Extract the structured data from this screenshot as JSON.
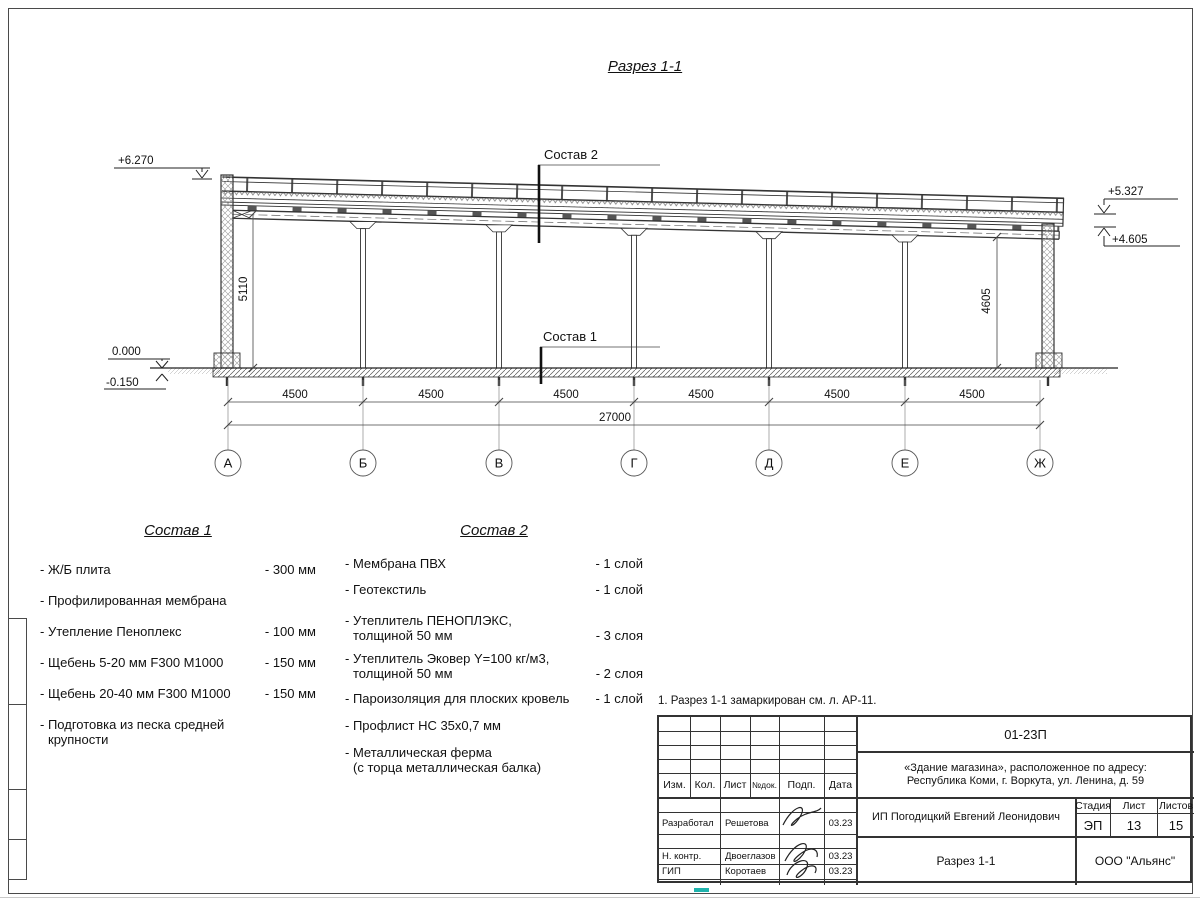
{
  "drawing": {
    "title": "Разрез 1-1",
    "callout_sostav2": "Состав 2",
    "callout_sostav1": "Состав 1",
    "elev_top_left": "+6.270",
    "elev_right_upper": "+5.327",
    "elev_right_lower": "+4.605",
    "elev_zero": "0.000",
    "elev_minus": "-0.150",
    "dim_left_height": "5110",
    "dim_right_height": "4605",
    "bay_dims": [
      "4500",
      "4500",
      "4500",
      "4500",
      "4500",
      "4500"
    ],
    "total_dim": "27000",
    "axes": [
      "А",
      "Б",
      "В",
      "Г",
      "Д",
      "Е",
      "Ж"
    ]
  },
  "sostav1": {
    "title": "Состав 1",
    "items": [
      {
        "name": "- Ж/Б плита",
        "value": "- 300 мм"
      },
      {
        "name": "- Профилированная мембрана",
        "value": ""
      },
      {
        "name": "- Утепление Пеноплекс",
        "value": "- 100 мм"
      },
      {
        "name": "-  Щебень 5-20 мм F300 М1000",
        "value": "- 150 мм"
      },
      {
        "name": "-  Щебень 20-40 мм F300 М1000",
        "value": "- 150 мм"
      },
      {
        "name": "- Подготовка из песка средней",
        "name2": "крупности",
        "value": ""
      }
    ]
  },
  "sostav2": {
    "title": "Состав 2",
    "items": [
      {
        "name": "- Мембрана ПВХ",
        "value": "- 1 слой"
      },
      {
        "name": "- Геотекстиль",
        "value": "- 1 слой"
      },
      {
        "name": "- Утеплитель ПЕНОПЛЭКС,",
        "name2": "толщиной 50 мм",
        "value": "- 3 слоя"
      },
      {
        "name": "- Утеплитель Эковер Y=100 кг/м3,",
        "name2": "толщиной 50 мм",
        "value": "- 2 слоя"
      },
      {
        "name": "- Пароизоляция для плоских кровель",
        "value": "- 1 слой"
      },
      {
        "name": "- Профлист НС 35х0,7 мм",
        "value": ""
      },
      {
        "name": "- Металлическая ферма",
        "name2": "(с торца металлическая балка)",
        "value": ""
      }
    ]
  },
  "note": "1. Разрез 1-1 замаркирован см. л. АР-11.",
  "titleblock": {
    "doc_number": "01-23П",
    "object_line1": "«Здание магазина», расположенное по адресу:",
    "object_line2": "Республика Коми, г. Воркута, ул. Ленина, д. 59",
    "client": "ИП Погодицкий Евгений Леонидович",
    "sheet_title": "Разрез 1-1",
    "company": "ООО \"Альянс\"",
    "stage_label": "Стадия",
    "stage_value": "ЭП",
    "sheet_label": "Лист",
    "sheet_value": "13",
    "sheets_label": "Листов",
    "sheets_value": "15",
    "cols": [
      "Изм.",
      "Кол.",
      "Лист",
      "№док.",
      "Подп.",
      "Дата"
    ],
    "rows": [
      {
        "role": "Разработал",
        "name": "Решетова",
        "date": "03.23"
      },
      {
        "role": "Н. контр.",
        "name": "Двоеглазов",
        "date": "03.23"
      },
      {
        "role": "ГИП",
        "name": "Коротаев",
        "date": "03.23"
      }
    ]
  }
}
